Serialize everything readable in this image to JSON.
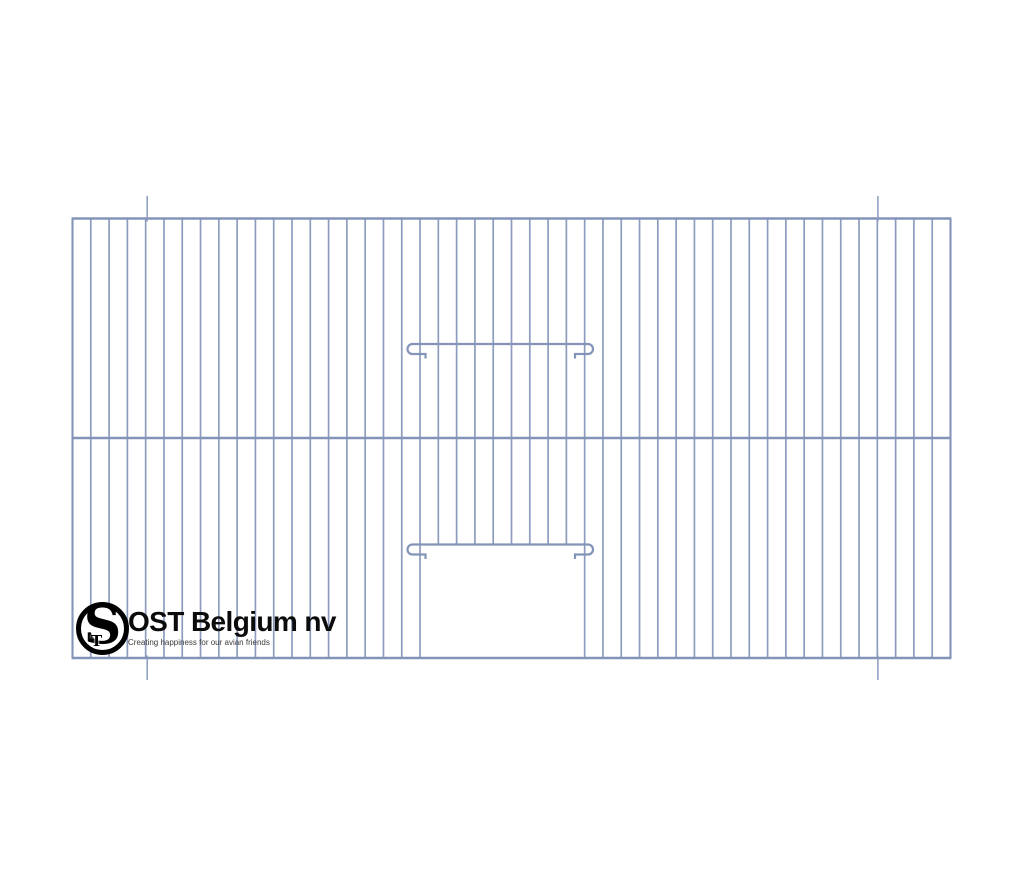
{
  "page": {
    "background": "#ffffff",
    "width": 1024,
    "height": 878
  },
  "logo": {
    "brand": "OST Belgium nv",
    "tagline": "Creating happiness for our avian friends",
    "monogram_s": "S",
    "monogram_t": "T"
  },
  "drawing": {
    "description": "bird-cage front wire panel technical drawing",
    "wire_color": "#8d9cbe",
    "heavy_wire_color": "#8394b8",
    "panel": {
      "left": 72.5,
      "top": 218.5,
      "right": 950.5,
      "bottom": 658,
      "mid_rail_y": 438
    },
    "bars": {
      "count": 49,
      "width": 1.7
    },
    "frame_width": 2.4,
    "mid_rail_width": 2.6,
    "door": {
      "left_bar_index": 19,
      "right_bar_index": 28,
      "top_y": 544.5
    },
    "slide_wires": {
      "ys": [
        344,
        544.5
      ],
      "width": 2.2,
      "arc_radius": 5,
      "left_arc_x": 412.5,
      "right_arc_x": 588,
      "stub_len": 13,
      "tick_len": 4.5
    },
    "crop_ticks": {
      "xs": [
        147.2,
        877.9
      ],
      "width": 1.5,
      "top": {
        "y1": 196,
        "y2": 221.5
      },
      "bottom": {
        "y1": 655.5,
        "y2": 680
      }
    }
  }
}
